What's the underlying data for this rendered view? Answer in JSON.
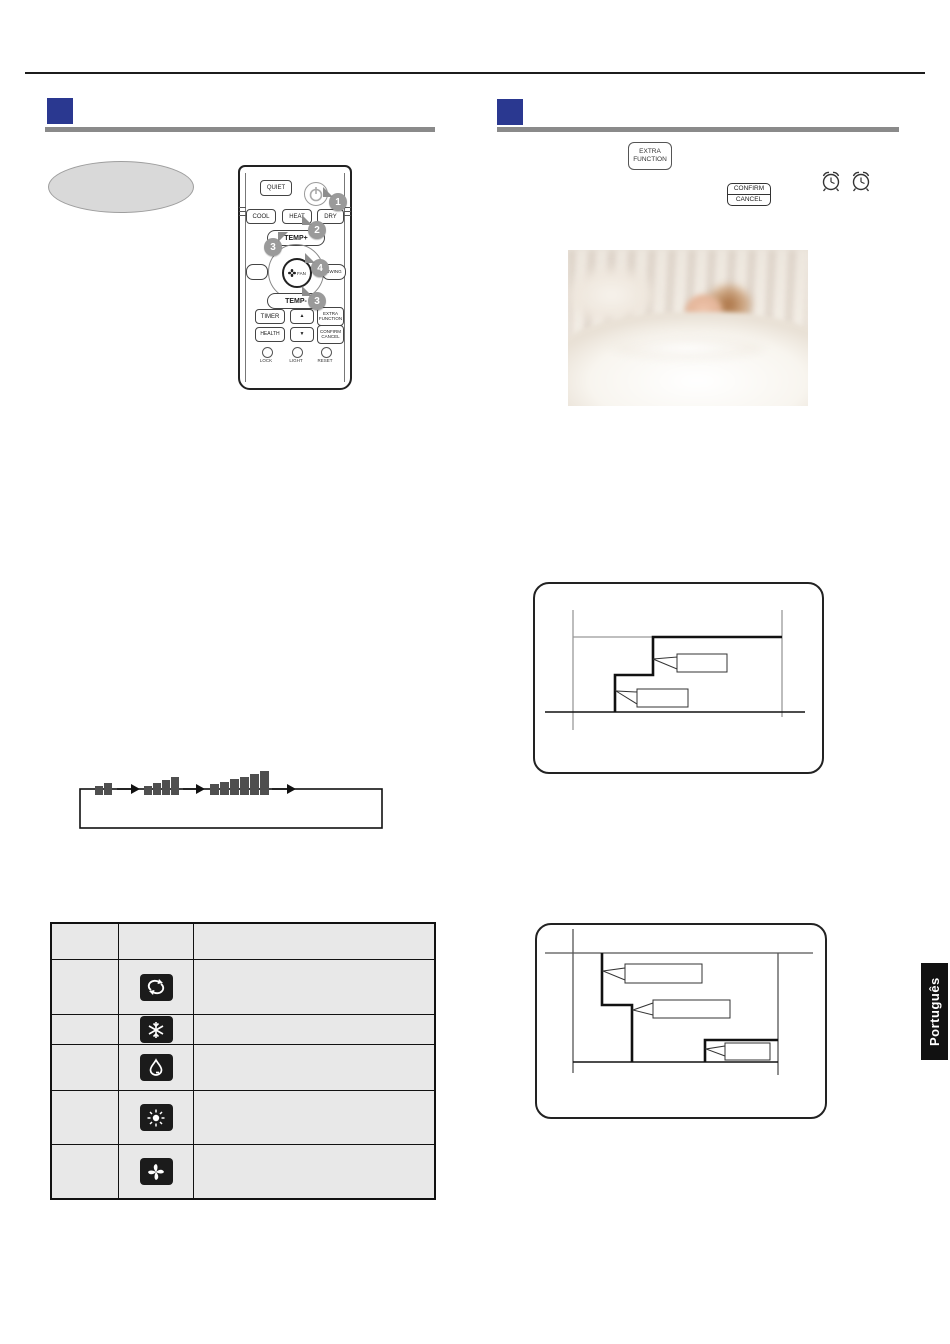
{
  "page": {
    "language_tab": "Português"
  },
  "colors": {
    "accent_blue": "#2a3890",
    "rule_gray": "#8a8a8a",
    "table_bg": "#e8e8e8",
    "tile_black": "#1b1b1b",
    "badge_gray": "#9a9a9a",
    "bar_gray": "#4f4f4f",
    "line_black": "#1c1c1c"
  },
  "remote": {
    "quiet": "QUIET",
    "modes": {
      "cool": "COOL",
      "heat": "HEAT",
      "dry": "DRY"
    },
    "temp_up": "TEMP+",
    "temp_down": "TEMP-",
    "center": {
      "fan": "FAN",
      "swing": "SWING"
    },
    "row1": {
      "timer": "TIMER",
      "up": "▲",
      "extra_function": [
        "EXTRA",
        "FUNCTION"
      ]
    },
    "row2": {
      "health": "HEALTH",
      "down": "▼",
      "confirm_cancel": [
        "CONFIRM",
        "CANCEL"
      ]
    },
    "bottom": {
      "lock": "LOCK",
      "light": "LIGHT",
      "reset": "RESET"
    },
    "badges": {
      "b1": "1",
      "b2": "2",
      "b3a": "3",
      "b4": "4",
      "b3b": "3"
    }
  },
  "right_column": {
    "extra_function_button": {
      "line1": "EXTRA",
      "line2": "FUNCTION"
    },
    "confirm_cancel_button": {
      "line1": "CONFIRM",
      "line2": "CANCEL"
    },
    "alarm_icons": [
      "alarm-clock",
      "alarm-clock"
    ]
  },
  "fan_cycle": {
    "steps": [
      "fan-speed-low",
      "fan-speed-medium",
      "fan-speed-high"
    ]
  },
  "mode_table": {
    "rows": [
      {
        "icon": "auto-icon"
      },
      {
        "icon": "snowflake-icon"
      },
      {
        "icon": "water-drop-icon"
      },
      {
        "icon": "sun-icon"
      },
      {
        "icon": "fan-icon"
      }
    ]
  },
  "diagrams": {
    "cool_sleep": {
      "callouts": [
        "",
        ""
      ]
    },
    "heat_sleep": {
      "callouts": [
        "",
        "",
        ""
      ]
    }
  }
}
